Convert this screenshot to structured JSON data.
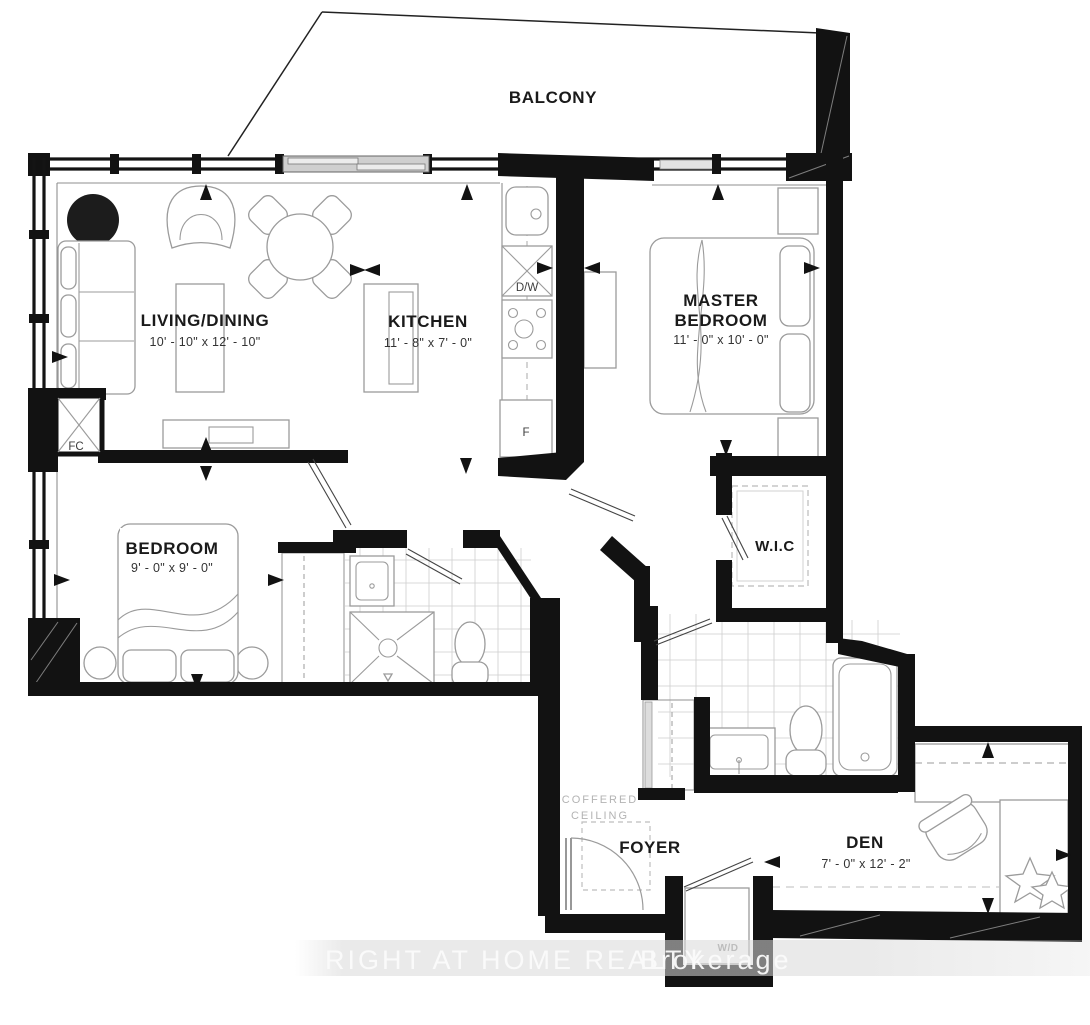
{
  "rooms": {
    "balcony": {
      "name": "BALCONY"
    },
    "living": {
      "name": "LIVING/DINING",
      "dims": "10' - 10\" x 12' - 10\""
    },
    "kitchen": {
      "name": "KITCHEN",
      "dims": "11' - 8\" x 7' - 0\""
    },
    "master": {
      "name1": "MASTER",
      "name2": "BEDROOM",
      "dims": "11' - 0\" x 10' - 0\""
    },
    "bedroom": {
      "name": "BEDROOM",
      "dims": "9' - 0\" x 9' - 0\""
    },
    "wic": {
      "name": "W.I.C"
    },
    "foyer": {
      "name": "FOYER"
    },
    "den": {
      "name": "DEN",
      "dims": "7' - 0\" x 12' - 2\""
    }
  },
  "labels": {
    "coffered1": "COFFERED",
    "coffered2": "CEILING",
    "dishwasher": "D/W",
    "fridge": "F",
    "fancoil": "FC",
    "washer_dryer": "W/D"
  },
  "watermark": {
    "realty": "RIGHT AT HOME REALTY",
    "brokerage": "Brokerage"
  },
  "colors": {
    "wall": "#121212",
    "furniture_outline": "#9b9b9b",
    "tile_grid": "#cdcdcd",
    "label_text": "#1a1a1a",
    "muted_text": "#b3b3b3",
    "watermark_band": "#d9d9d9"
  }
}
